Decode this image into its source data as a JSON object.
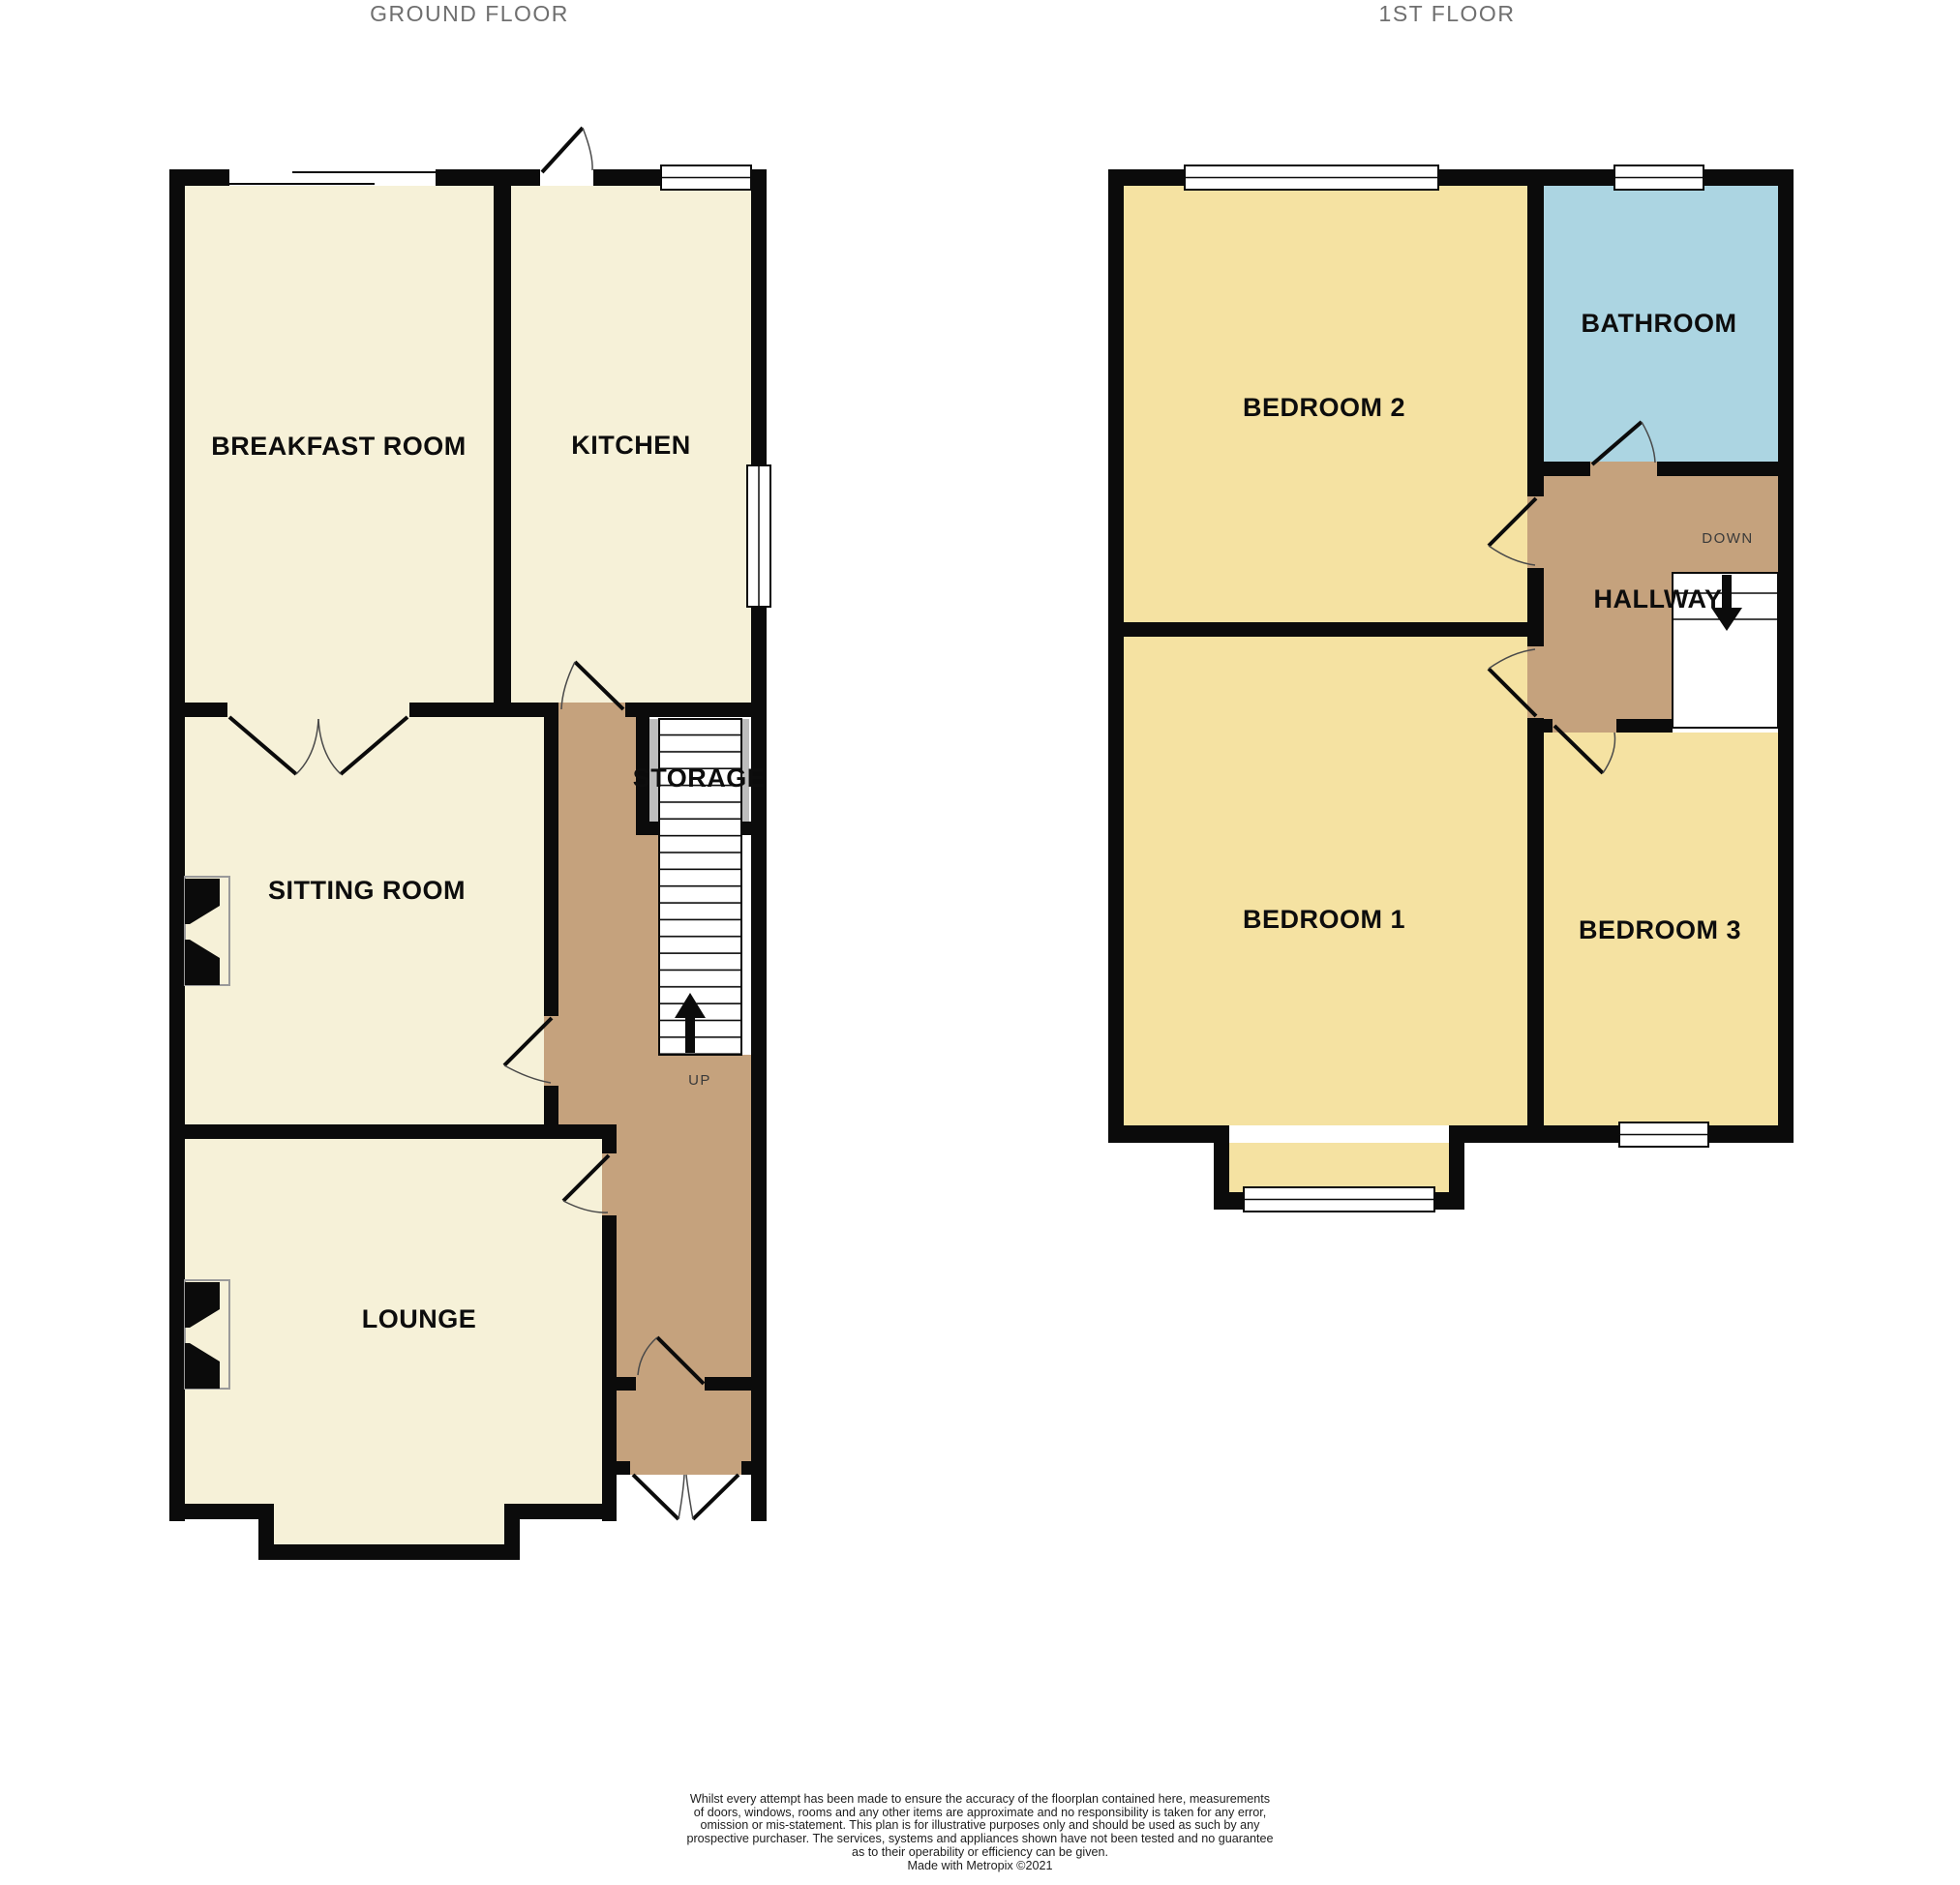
{
  "ground_floor": {
    "title": "GROUND FLOOR",
    "rooms": {
      "breakfast_room": "BREAKFAST ROOM",
      "kitchen": "KITCHEN",
      "sitting_room": "SITTING ROOM",
      "storage": "STORAGE",
      "lounge": "LOUNGE"
    },
    "stair_direction": "UP"
  },
  "first_floor": {
    "title": "1ST FLOOR",
    "rooms": {
      "bedroom_2": "BEDROOM 2",
      "bathroom": "BATHROOM",
      "hallway": "HALLWAY",
      "bedroom_1": "BEDROOM 1",
      "bedroom_3": "BEDROOM 3"
    },
    "stair_direction": "DOWN"
  },
  "disclaimer_lines": [
    "Whilst every attempt has been made to ensure the accuracy of the floorplan contained here, measurements",
    "of doors, windows, rooms and any other items are approximate and no responsibility is taken for any error,",
    "omission or mis-statement. This plan is for illustrative purposes only and should be used as such by any",
    "prospective purchaser. The services, systems and appliances shown have not been tested and no guarantee",
    "as to their operability or efficiency can be given."
  ],
  "credit": "Made with Metropix ©2021",
  "colors": {
    "room_cream": "#F6F1D8",
    "bedroom_yellow": "#F5E2A2",
    "hallway_tan": "#C5A27D",
    "bathroom_blue": "#ACD5E2",
    "wall_black": "#0B0B0B",
    "title_gray": "#6F6F6F"
  }
}
